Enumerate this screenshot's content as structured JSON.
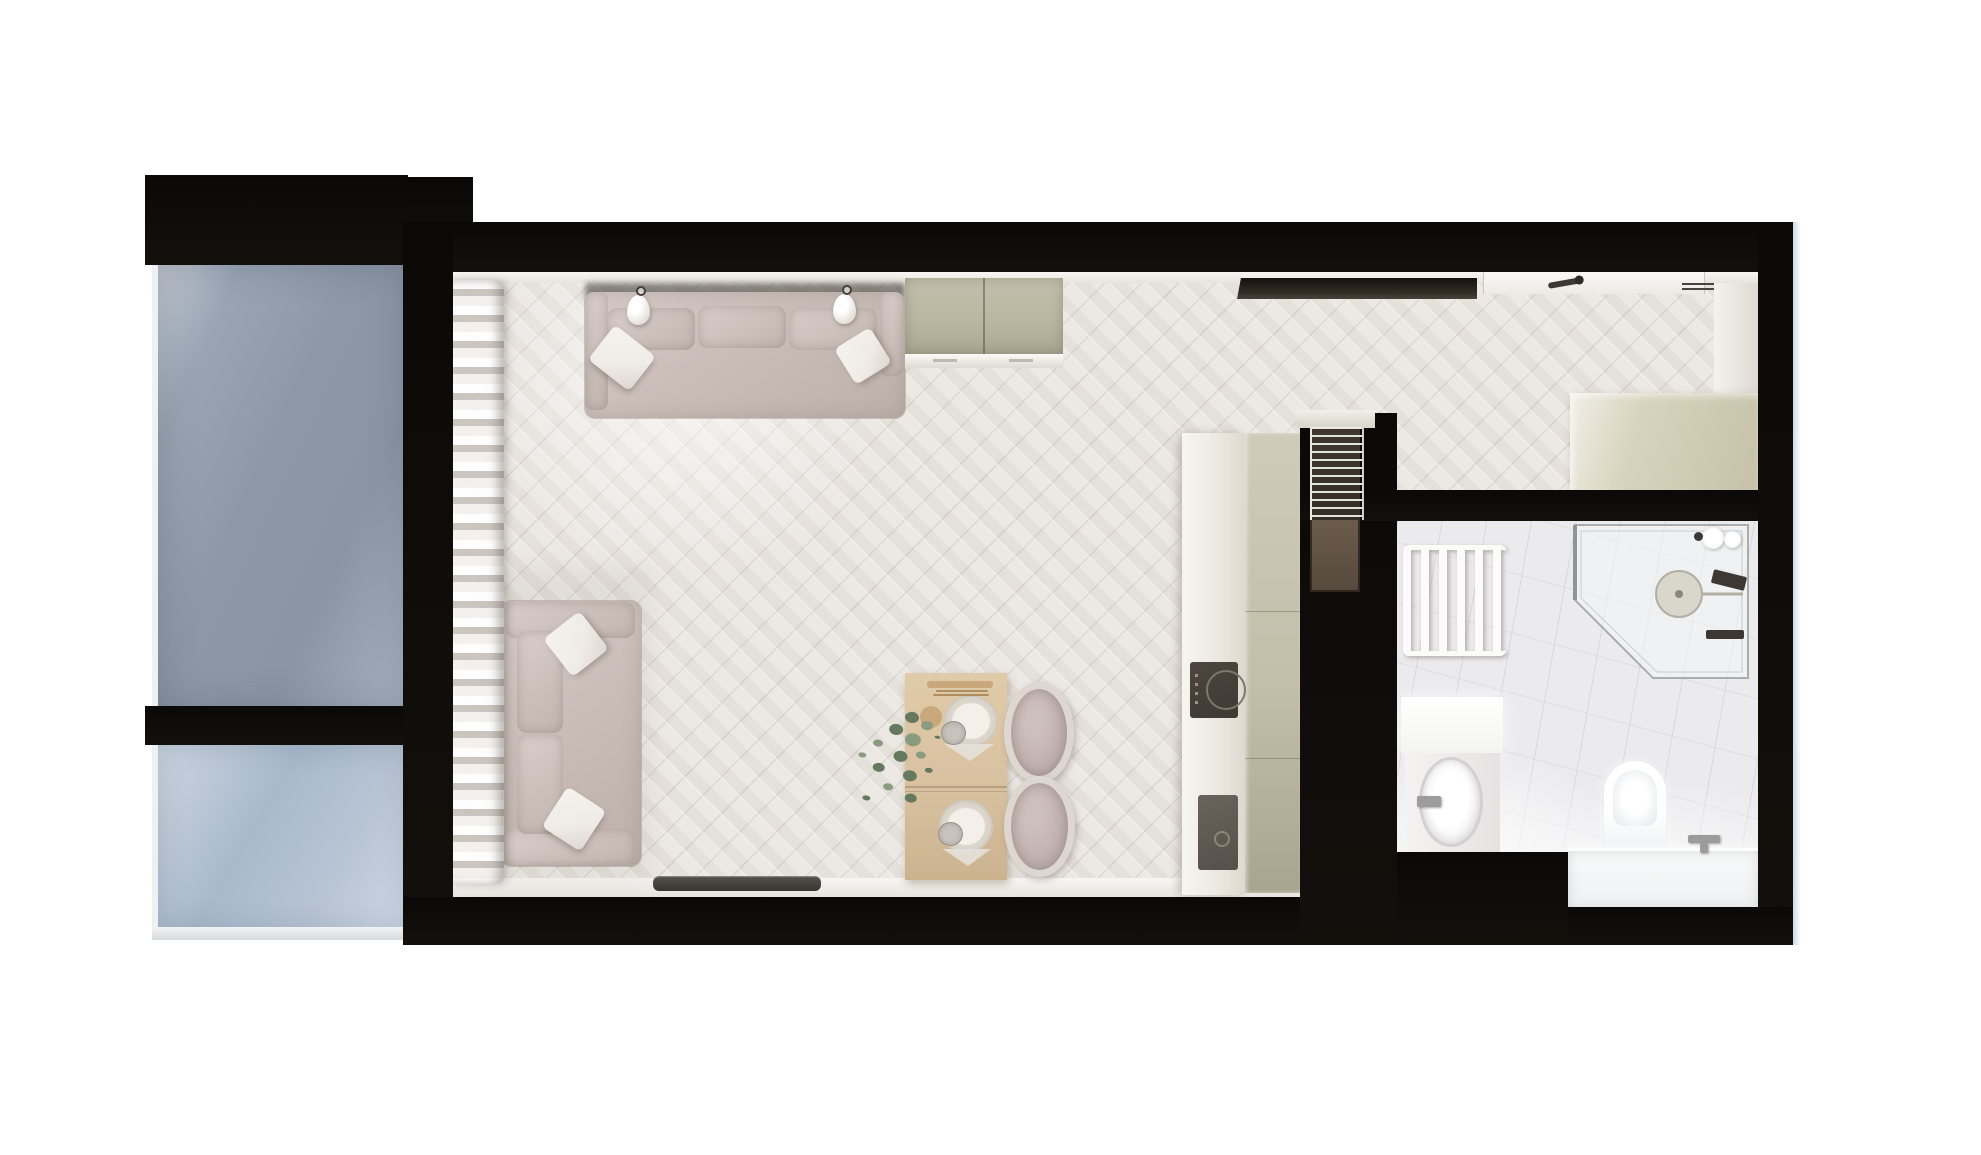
{
  "scene": {
    "description": "Top-down 3D architectural render of a studio apartment",
    "view": "top-down floor plan render",
    "rooms": [
      {
        "name": "balcony",
        "position": "left",
        "features": [
          "upper glass panel",
          "lower glass panel",
          "black mullion frame"
        ]
      },
      {
        "name": "living-room",
        "position": "center",
        "floor": "herringbone light wood"
      },
      {
        "name": "kitchen",
        "position": "center-right",
        "features": [
          "counter run",
          "tall cabinet column"
        ]
      },
      {
        "name": "hallway",
        "position": "top-right",
        "features": [
          "entrance door",
          "transom glass strip",
          "wardrobe"
        ]
      },
      {
        "name": "bathroom",
        "position": "right",
        "floor": "white marble"
      }
    ],
    "furniture": {
      "living_room": [
        "three-seat sofa with two pillows",
        "two pendant lamps",
        "khaki sideboard",
        "two-seat sofa with two pillows",
        "sheer curtains",
        "wooden dining table",
        "two round upholstered chairs",
        "two place settings with plates and cups",
        "cutting board with utensils",
        "green plant"
      ],
      "kitchen": [
        "white counter",
        "induction hob",
        "dark sink",
        "khaki tall cabinet",
        "wire rack in wall niche"
      ],
      "hallway": [
        "entrance door with handle",
        "dark transom glazing",
        "beige wardrobe",
        "ceiling vent"
      ],
      "bathroom": [
        "white towel radiator",
        "corner shower with glass enclosure",
        "round shower head",
        "vanity with oval basin",
        "wall faucet",
        "toilet",
        "bathtub with filler",
        "toiletries"
      ]
    }
  },
  "colors": {
    "wall": "#0b0907",
    "floor": "#eae6e1",
    "marble": "#ebeaec",
    "frame": "#eef1f3",
    "glass-upper": "#8c97a7",
    "glass-lower": "#a9b9cc",
    "sofa": "#cabdb8",
    "pillow": "#efebe6",
    "sideboard": "#b8b5a1",
    "counter": "#ece9e1",
    "cabinet": "#c2beaa",
    "hob": "#3f3933",
    "sink": "#57504a",
    "closet": "#d8d3bc",
    "wood": "#d8c1a0",
    "chair-ring": "#ddd6d1",
    "chair-seat": "#bcadab",
    "plant-dark": "#66795f",
    "plant-light": "#8a9c80",
    "radiator": "#fbfbfa",
    "fixture": "#3d3834",
    "threshold": "#38342f",
    "glass-strip": "#342d26",
    "rack-back": "#40372e",
    "rack-brown": "#6b5b4c",
    "right-edge": "#c3d0df"
  }
}
